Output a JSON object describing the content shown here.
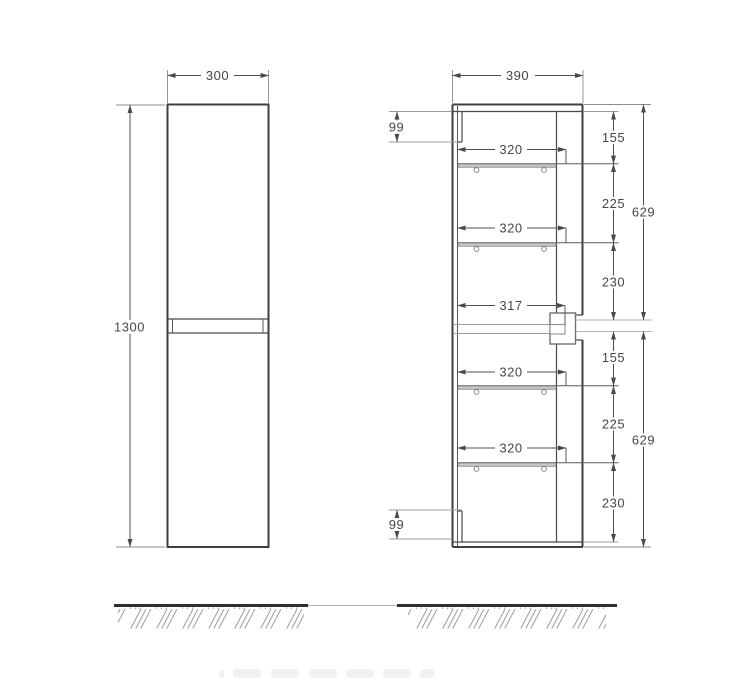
{
  "drawing_type": "cabinet-dimension-drawing",
  "colors": {
    "line": "#3f3f3f",
    "light_line": "#a6a6a6",
    "text": "#474747",
    "ground": "#2e2e2e"
  },
  "front_view": {
    "width": "300",
    "height": "1300"
  },
  "side_view": {
    "depth": "390",
    "rail_top": "99",
    "rail_bottom": "99",
    "mid_depth": "317",
    "shelves": {
      "s1": "320",
      "s2": "320",
      "s3": "320",
      "s4": "320"
    },
    "top": {
      "a": "155",
      "b": "225",
      "c": "230",
      "total": "629"
    },
    "bottom": {
      "a": "155",
      "b": "225",
      "c": "230",
      "total": "629"
    }
  }
}
